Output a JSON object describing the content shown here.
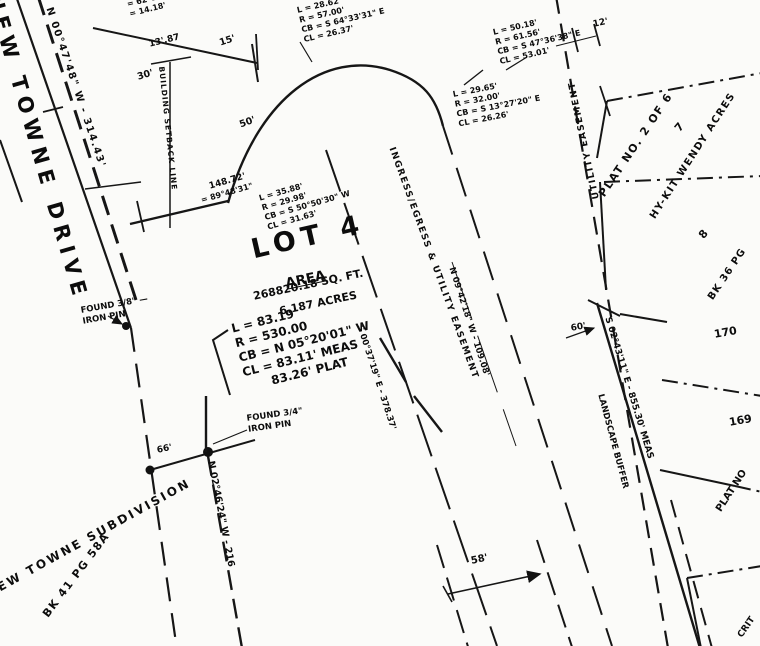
{
  "plat": {
    "street_name": "NEW TOWNE DRIVE",
    "street_bearing": "N 00°47'48\" W - 314.43'",
    "setback_label": "BUILDING SETBACK LINE",
    "delta_block": {
      "line1": "= 62°18'12\" E",
      "line2": "= 14.18'"
    },
    "dims": {
      "d13": "13'.87",
      "d15": "15'",
      "d30": "30'",
      "d50": "50'",
      "d12": "12'",
      "d148": "148.72'",
      "b148": "= 89°48'31\"",
      "d66": "66'",
      "d58": "58'",
      "d60": "60'"
    },
    "curve1": {
      "l": "L = 28.62'",
      "r": "R = 57.00'",
      "cb": "CB = S 64°33'31\" E",
      "cl": "CL = 26.37'"
    },
    "curve2": {
      "l": "L = 50.18'",
      "r": "R = 61.56'",
      "cb": "CB = S 47°36'38\" E",
      "cl": "CL = 53.01'"
    },
    "curve3": {
      "l": "L = 29.65'",
      "r": "R = 32.00'",
      "cb": "CB = S 13°27'20\" E",
      "cl": "CL = 26.26'"
    },
    "curve4": {
      "l": "L = 35.88'",
      "r": "R = 29.98'",
      "cb": "CB = S 50°50'30\" W",
      "cl": "CL = 31.63'"
    },
    "lot_title": "LOT 4",
    "area_heading": "AREA",
    "area_sqft": "268820.18 SQ. FT.",
    "area_acres": "6.187 ACRES",
    "main_curve": {
      "l": "L = 83.19'",
      "r": "R = 530.00",
      "cb": "CB = N 05°20'01\" W",
      "cl": "CL = 83.11' MEAS",
      "plat": "83.26' PLAT"
    },
    "found_pin_38": {
      "line1": "FOUND 3/8\" —",
      "line2": "IRON PIN"
    },
    "found_pin_34": {
      "line1": "FOUND 3/4\"",
      "line2": "IRON PIN"
    },
    "easement_diag": "INGRESS/EGRESS & UTILITY EASEMENT",
    "bearing_109": "N 09°42'18\" W - 109.08'",
    "bearing_378": "S 00°37'19\" E - 378.37'",
    "utility_easement": "UTILITY EASEMENT",
    "plat_no_2of6": "PLAT NO. 2 OF 6",
    "lot_7": "7",
    "hykit": "HY-KIT WENDY ACRES",
    "lot_8": "8",
    "bk36": "BK 36 PG",
    "east_boundary_bearing": "S 02°43'11\" E - 855.30' MEAS",
    "landscape_buffer": "LANDSCAPE BUFFER",
    "lot_170": "170",
    "lot_169": "169",
    "plat_no_right": "PLAT NO",
    "corner_partial": "CRIT",
    "subdivision_name": "NEW TOWNE SUBDIVISION",
    "bk41": "BK 41 PG 58A",
    "south_bearing": "N 02°46'24\" W - 216"
  }
}
